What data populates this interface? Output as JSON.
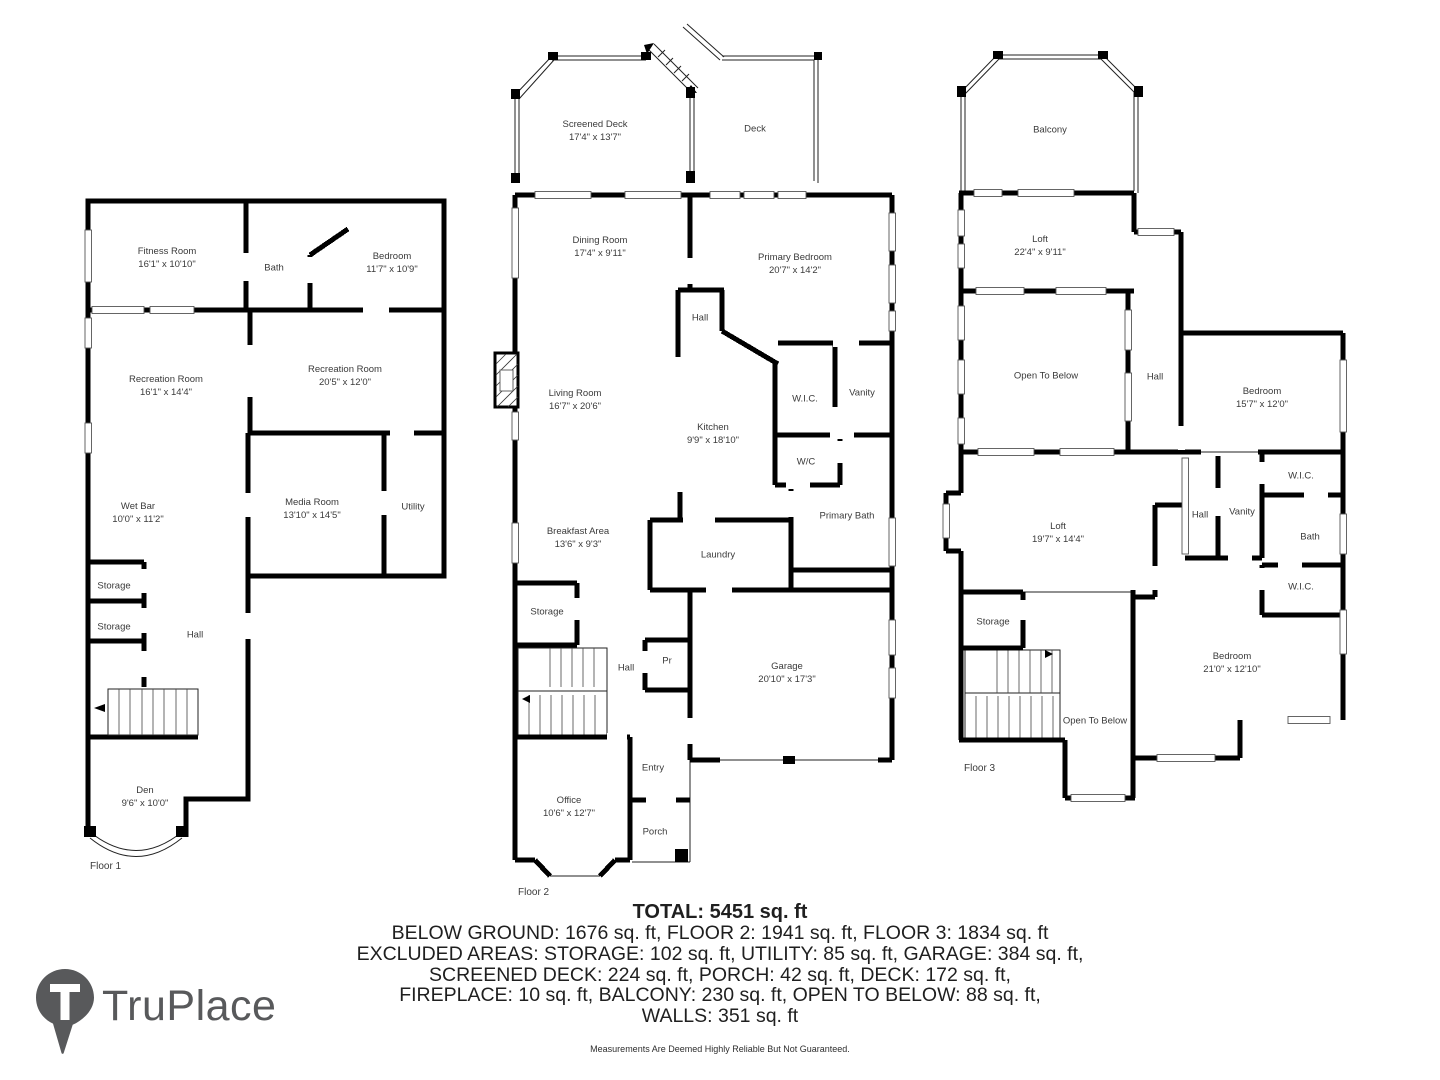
{
  "floor1": {
    "label": "Floor 1",
    "rooms": {
      "fitness": {
        "name": "Fitness Room",
        "dims": "16'1\" x 10'10\""
      },
      "bath": {
        "name": "Bath"
      },
      "bedroom": {
        "name": "Bedroom",
        "dims": "11'7\" x 10'9\""
      },
      "rec1": {
        "name": "Recreation Room",
        "dims": "16'1\" x 14'4\""
      },
      "rec2": {
        "name": "Recreation Room",
        "dims": "20'5\" x 12'0\""
      },
      "wetbar": {
        "name": "Wet Bar",
        "dims": "10'0\" x 11'2\""
      },
      "media": {
        "name": "Media Room",
        "dims": "13'10\" x 14'5\""
      },
      "utility": {
        "name": "Utility"
      },
      "storage1": {
        "name": "Storage"
      },
      "storage2": {
        "name": "Storage"
      },
      "hall": {
        "name": "Hall"
      },
      "den": {
        "name": "Den",
        "dims": "9'6\" x 10'0\""
      }
    }
  },
  "floor2": {
    "label": "Floor 2",
    "rooms": {
      "screened_deck": {
        "name": "Screened Deck",
        "dims": "17'4\" x 13'7\""
      },
      "deck": {
        "name": "Deck"
      },
      "dining": {
        "name": "Dining Room",
        "dims": "17'4\" x 9'11\""
      },
      "primary_bedroom": {
        "name": "Primary Bedroom",
        "dims": "20'7\" x 14'2\""
      },
      "hall_upper": {
        "name": "Hall"
      },
      "living": {
        "name": "Living Room",
        "dims": "16'7\" x 20'6\""
      },
      "kitchen": {
        "name": "Kitchen",
        "dims": "9'9\" x 18'10\""
      },
      "wic": {
        "name": "W.I.C."
      },
      "vanity": {
        "name": "Vanity"
      },
      "wc": {
        "name": "W/C"
      },
      "primary_bath": {
        "name": "Primary Bath"
      },
      "breakfast": {
        "name": "Breakfast Area",
        "dims": "13'6\" x 9'3\""
      },
      "laundry": {
        "name": "Laundry"
      },
      "storage": {
        "name": "Storage"
      },
      "hall_lower": {
        "name": "Hall"
      },
      "pr": {
        "name": "Pr"
      },
      "garage": {
        "name": "Garage",
        "dims": "20'10\" x 17'3\""
      },
      "entry": {
        "name": "Entry"
      },
      "office": {
        "name": "Office",
        "dims": "10'6\" x 12'7\""
      },
      "porch": {
        "name": "Porch"
      }
    }
  },
  "floor3": {
    "label": "Floor 3",
    "rooms": {
      "balcony": {
        "name": "Balcony"
      },
      "loft1": {
        "name": "Loft",
        "dims": "22'4\" x 9'11\""
      },
      "open_below1": {
        "name": "Open To Below"
      },
      "hall_upper": {
        "name": "Hall"
      },
      "bedroom1": {
        "name": "Bedroom",
        "dims": "15'7\" x 12'0\""
      },
      "wic1": {
        "name": "W.I.C."
      },
      "vanity": {
        "name": "Vanity"
      },
      "hall_lower": {
        "name": "Hall"
      },
      "bath": {
        "name": "Bath"
      },
      "wic2": {
        "name": "W.I.C."
      },
      "loft2": {
        "name": "Loft",
        "dims": "19'7\" x 14'4\""
      },
      "storage": {
        "name": "Storage"
      },
      "open_below2": {
        "name": "Open To Below"
      },
      "bedroom2": {
        "name": "Bedroom",
        "dims": "21'0\" x 12'10\""
      }
    }
  },
  "summary": {
    "total": "TOTAL: 5451 sq. ft",
    "lines": [
      "BELOW GROUND: 1676 sq. ft, FLOOR 2: 1941 sq. ft, FLOOR 3: 1834 sq. ft",
      "EXCLUDED AREAS: STORAGE: 102 sq. ft, UTILITY: 85 sq. ft, GARAGE: 384 sq. ft,",
      "SCREENED DECK: 224 sq. ft, PORCH: 42 sq. ft, DECK: 172 sq. ft,",
      "FIREPLACE: 10 sq. ft, BALCONY: 230 sq. ft, OPEN TO BELOW: 88 sq. ft,",
      "WALLS: 351 sq. ft"
    ],
    "disclaimer": "Measurements Are Deemed Highly Reliable But Not Guaranteed."
  },
  "logo": {
    "brand": "TruPlace"
  },
  "colors": {
    "wall": "#000000",
    "text": "#3a3a3a",
    "brand_gray": "#58595b"
  }
}
